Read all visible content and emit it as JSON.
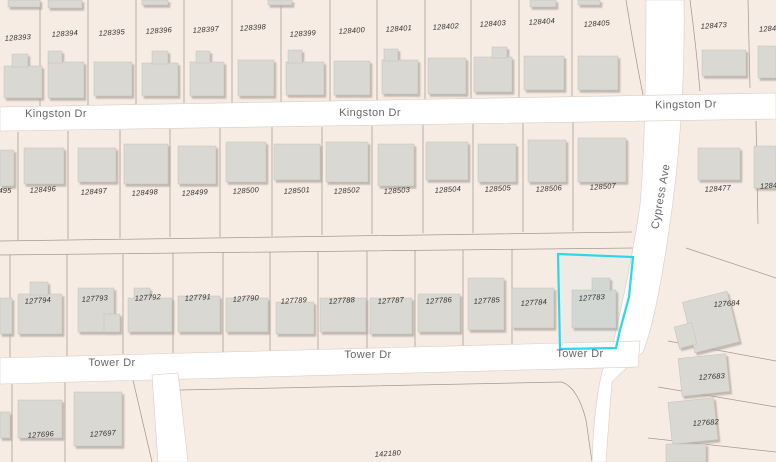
{
  "map": {
    "streets": {
      "kingston": "Kingston Dr",
      "tower": "Tower Dr",
      "cypress": "Cypress Ave"
    },
    "selected_parcel": {
      "id": "127783",
      "color": "#2fd6e8"
    },
    "parcels": {
      "row_north": [
        "128393",
        "128394",
        "128395",
        "128396",
        "128397",
        "128398",
        "128399",
        "128400",
        "128401",
        "128402",
        "128403",
        "128404",
        "128405"
      ],
      "row_north_east": [
        "128473",
        "12847"
      ],
      "row_mid": [
        "495",
        "128496",
        "128497",
        "128498",
        "128499",
        "128500",
        "128501",
        "128502",
        "128503",
        "128504",
        "128505",
        "128506",
        "128507"
      ],
      "row_mid_east": [
        "128477",
        "12847"
      ],
      "row_south": [
        "127794",
        "127793",
        "127792",
        "127791",
        "127790",
        "127789",
        "127788",
        "127787",
        "127786",
        "127785",
        "127784"
      ],
      "east_column": [
        "127684",
        "127683",
        "127682"
      ],
      "south_block": [
        "127696",
        "127697"
      ],
      "large_parcel": "142180"
    }
  }
}
